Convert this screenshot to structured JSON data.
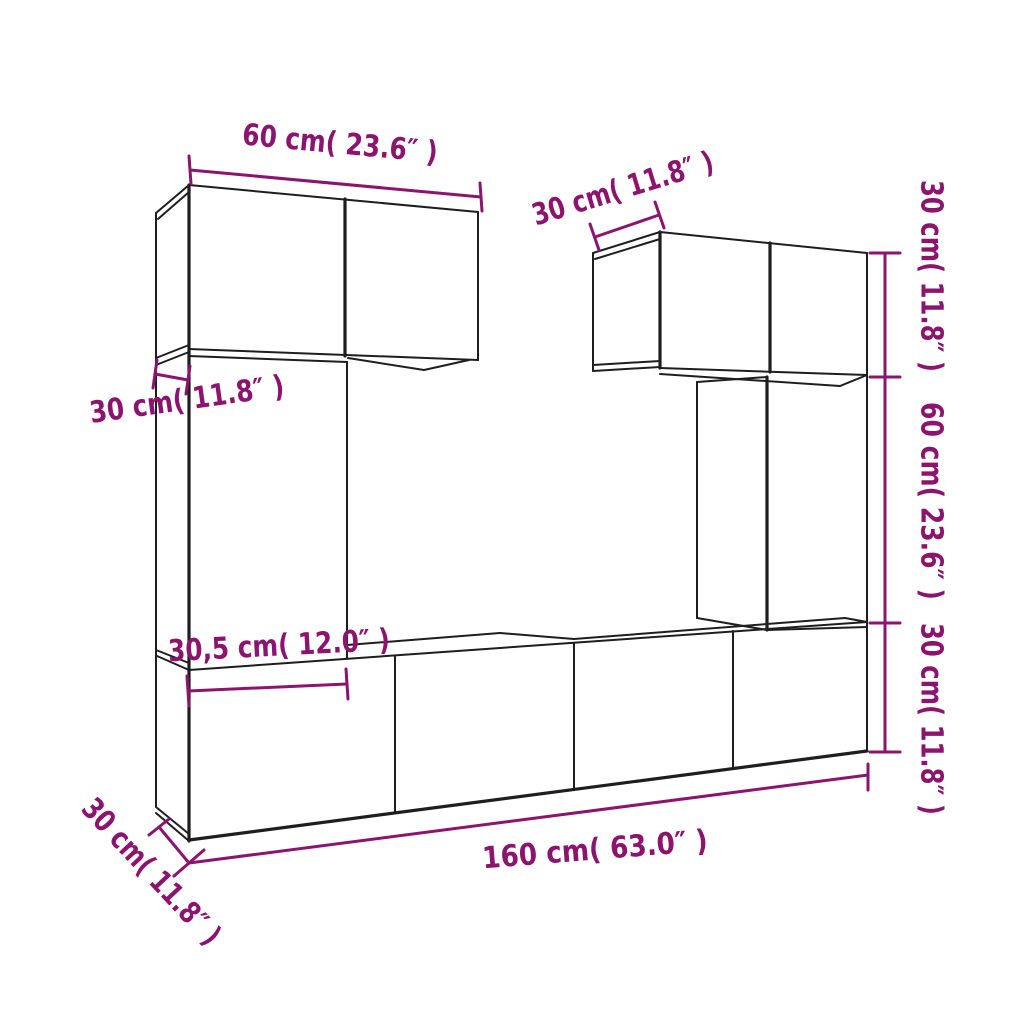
{
  "diagram": {
    "type": "furniture-dimension-line-drawing",
    "subject": "wall-mounted TV cabinet set (6 boxes) shown in perspective with dimension lines",
    "colors": {
      "background": "#ffffff",
      "line": "#1e1e1e",
      "accent": "#8c146e"
    },
    "labels": {
      "top_cabinet_width": "60 cm( 23.6″ )",
      "right_cabinet_depth": "30 cm( 11.8″ )",
      "right_height_top": "30 cm( 11.8″ )",
      "right_height_middle": "60 cm( 23.6″ )",
      "right_height_bottom": "30 cm( 11.8″ )",
      "left_column_depth": "30 cm( 11.8″ )",
      "column_width": "30,5 cm( 12.0″ )",
      "bottom_row_depth": "30 cm( 11.8″ )",
      "bottom_row_width": "160 cm( 63.0″ )"
    },
    "measurements": [
      {
        "id": "top_cabinet_width",
        "cm": "60",
        "inches": "23.6",
        "text": "60 cm( 23.6″ )",
        "placement": "above top-left cabinet, horizontal"
      },
      {
        "id": "right_cabinet_depth",
        "cm": "30",
        "inches": "11.8",
        "text": "30 cm( 11.8″ )",
        "placement": "above top-right cabinet, along depth edge"
      },
      {
        "id": "right_height_top",
        "cm": "30",
        "inches": "11.8",
        "text": "30 cm( 11.8″ )",
        "placement": "right side vertical, top segment"
      },
      {
        "id": "right_height_middle",
        "cm": "60",
        "inches": "23.6",
        "text": "60 cm( 23.6″ )",
        "placement": "right side vertical, middle segment"
      },
      {
        "id": "right_height_bottom",
        "cm": "30",
        "inches": "11.8",
        "text": "30 cm( 11.8″ )",
        "placement": "right side vertical, bottom segment"
      },
      {
        "id": "left_column_depth",
        "cm": "30",
        "inches": "11.8",
        "text": "30 cm( 11.8″ )",
        "placement": "left side, along depth edge of tall column"
      },
      {
        "id": "column_width",
        "cm": "30,5",
        "inches": "12.0",
        "text": "30,5 cm( 12.0″ )",
        "placement": "middle, width of tall column"
      },
      {
        "id": "bottom_row_depth",
        "cm": "30",
        "inches": "11.8",
        "text": "30 cm( 11.8″ )",
        "placement": "bottom-left, along depth edge, diagonal"
      },
      {
        "id": "bottom_row_width",
        "cm": "160",
        "inches": "63.0",
        "text": "160 cm( 63.0″ )",
        "placement": "below bottom row, full width"
      }
    ]
  }
}
